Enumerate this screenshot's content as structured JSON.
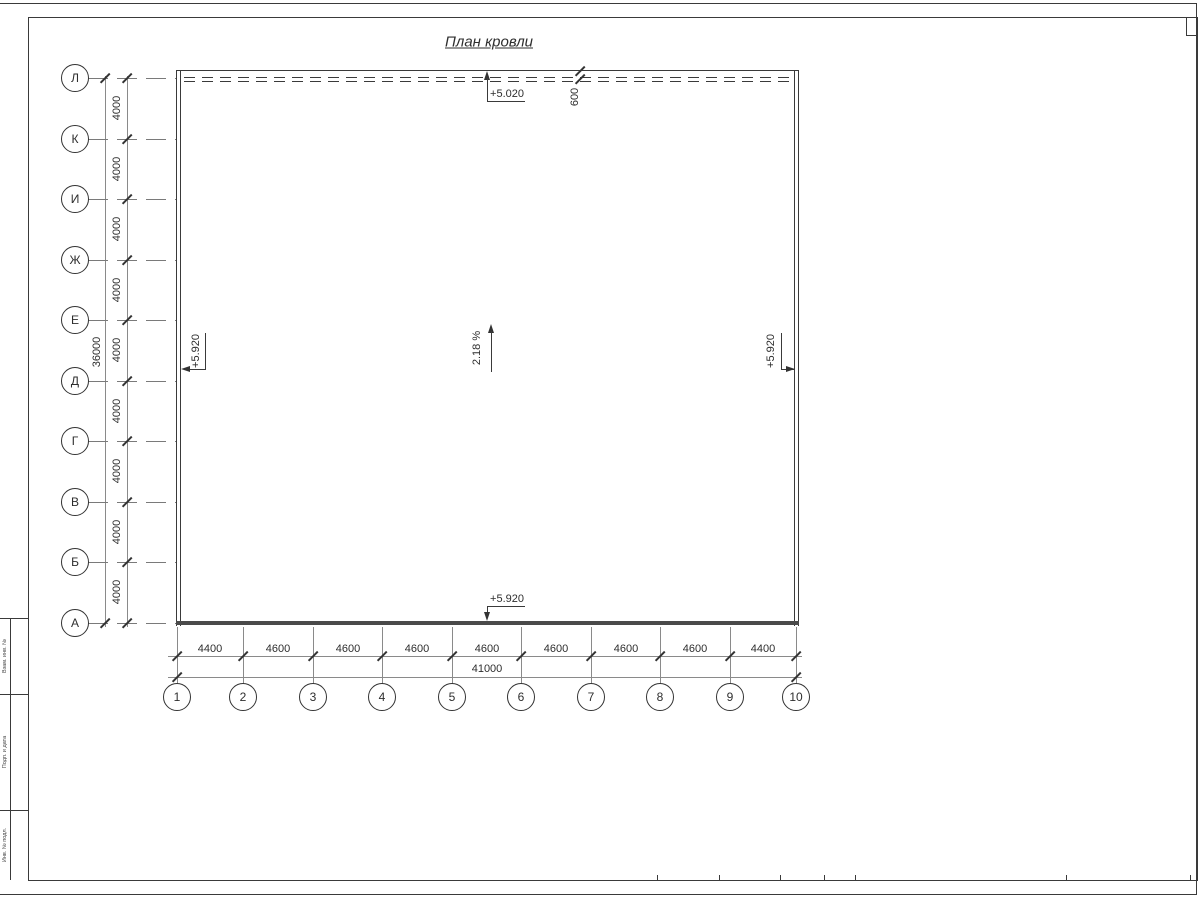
{
  "title": "План кровли",
  "grid": {
    "row_labels": [
      "Л",
      "К",
      "И",
      "Ж",
      "Е",
      "Д",
      "Г",
      "В",
      "Б",
      "А"
    ],
    "row_dims": [
      "4000",
      "4000",
      "4000",
      "4000",
      "4000",
      "4000",
      "4000",
      "4000",
      "4000"
    ],
    "row_total": "36000",
    "col_labels": [
      "1",
      "2",
      "3",
      "4",
      "5",
      "6",
      "7",
      "8",
      "9",
      "10"
    ],
    "col_dims": [
      "4400",
      "4600",
      "4600",
      "4600",
      "4600",
      "4600",
      "4600",
      "4600",
      "4400"
    ],
    "col_total": "41000"
  },
  "annotations": {
    "elevation_top": "+5.020",
    "elevation_bottom": "+5.920",
    "elevation_left": "+5.920",
    "elevation_right": "+5.920",
    "slope": "2.18 %",
    "eave_offset": "600"
  },
  "side_stamp": {
    "labels": [
      "Взам. инв. №",
      "Подп. и дата",
      "Инв. № подл."
    ]
  },
  "colors": {
    "line": "#3a3a3a",
    "thick_line": "#4a4a4a"
  }
}
